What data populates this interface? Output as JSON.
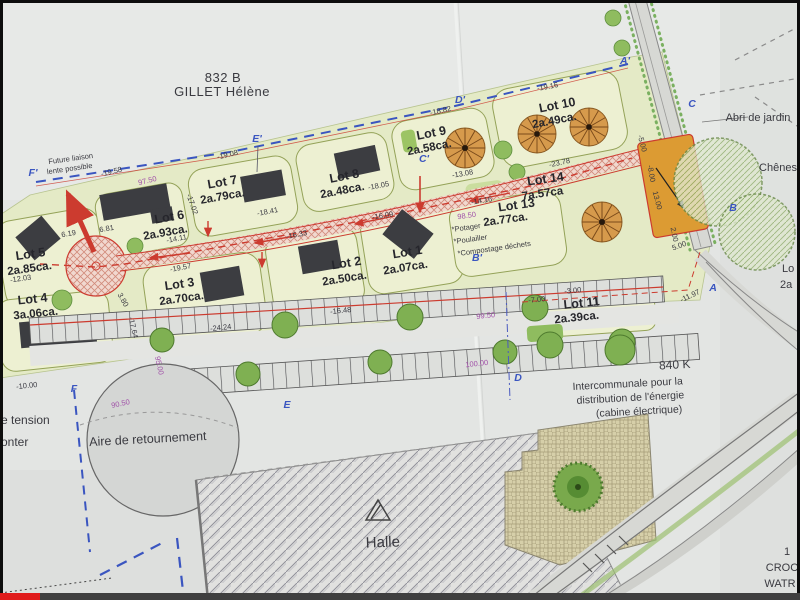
{
  "video": {
    "progress_color": "#e01b1b"
  },
  "plan": {
    "title_parcel": {
      "id": "832 B",
      "owner": "GILLET Hélène"
    },
    "notes": {
      "future_link_line1": "Future liaison",
      "future_link_line2": "lente possible",
      "abri_de_jardin": "Abri de jardin",
      "chenes": "Chênes",
      "aire_de_retournement": "Aire de retournement",
      "halle": "Halle",
      "tension_fragment_line1": "e tension",
      "tension_fragment_line2": "onter",
      "corner_fragment_line1": "1",
      "corner_fragment_line2": "CROC",
      "corner_fragment_line3": "WATR",
      "right_fragment_line1": "Lo",
      "right_fragment_line2": "2a"
    },
    "energy_cabin": {
      "ref": "840 K",
      "line1": "Intercommunale pour la",
      "line2": "distribution de l'énergie",
      "line3": "(cabine électrique)"
    },
    "lots": [
      {
        "name": "Lot 1",
        "area": "2a.07ca."
      },
      {
        "name": "Lot 2",
        "area": "2a.50ca."
      },
      {
        "name": "Lot 3",
        "area": "2a.70ca."
      },
      {
        "name": "Lot 4",
        "area": "3a.06ca."
      },
      {
        "name": "Lot 5",
        "area": "2a.85ca."
      },
      {
        "name": "Lot 6",
        "area": "2a.93ca."
      },
      {
        "name": "Lot 7",
        "area": "2a.79ca."
      },
      {
        "name": "Lot 8",
        "area": "2a.48ca."
      },
      {
        "name": "Lot 9",
        "area": "2a.58ca."
      },
      {
        "name": "Lot 10",
        "area": "2a.49ca."
      },
      {
        "name": "Lot 11",
        "area": "2a.39ca."
      },
      {
        "name": "Lot 13",
        "area": "2a.77ca.",
        "notes": [
          "*Potager",
          "*Poulailler",
          "*Compostage déchets"
        ]
      },
      {
        "name": "Lot 14",
        "area": "7a.57ca"
      }
    ],
    "boundary_markers": [
      "F'",
      "E'",
      "D'",
      "C'",
      "C",
      "B'",
      "B",
      "A'",
      "A",
      "D",
      "E",
      "F"
    ],
    "contour_labels": [
      "97.50",
      "98.50",
      "99.50",
      "100.00",
      "90.50",
      "95.00"
    ],
    "measurements": [
      "-19.58",
      "-19.08",
      "-18.82",
      "-19.16",
      "-18.41",
      "-18.05",
      "-16.33",
      "-16.09",
      "-13.08",
      "-23.78",
      "-14.16",
      "-17.02",
      "-14.11",
      "-19.57",
      "-12.03",
      "-10.00",
      "-24.24",
      "-16.48",
      "-11.97",
      "-3.00",
      "-7.00",
      "-5.00",
      "-8.00",
      "13.00",
      "5.00",
      "6.81",
      "6.19",
      "3.80",
      "-17.64",
      "2.00"
    ],
    "colors": {
      "paper": "#e3e5e3",
      "lot_fill": "#edf0d2",
      "road_red": "#cc3b2f",
      "tree_orange": "#d69a4c",
      "marker_blue": "#3a55c0",
      "contour_purple": "#a050a8",
      "orange_parcel": "#dc9b33"
    }
  }
}
